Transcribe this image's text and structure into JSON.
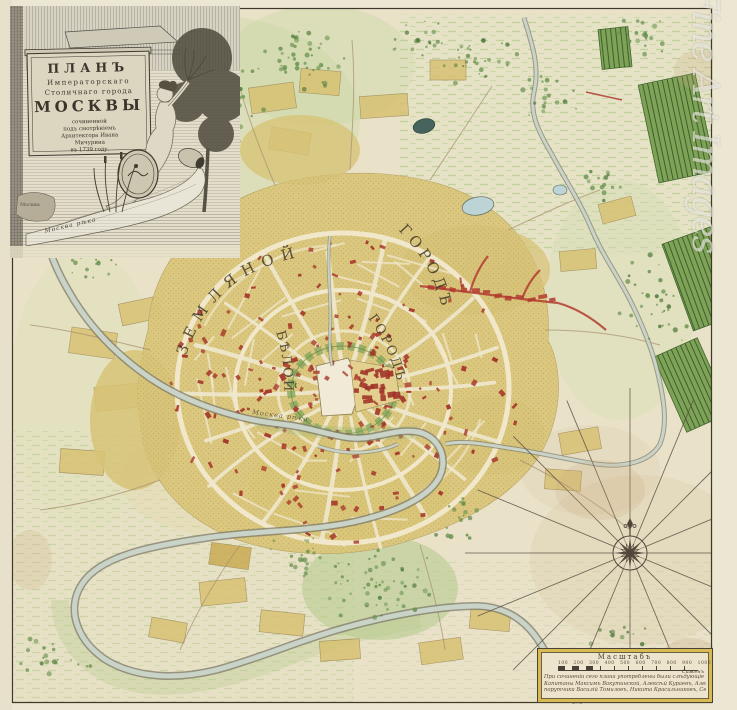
{
  "title_cartouche": {
    "l1": "ПЛАНЪ",
    "l2": "Императорскаго",
    "l3": "Столичнаго города",
    "l4": "МОСКВЫ",
    "l5": "сочиненной",
    "l6": "подъ смотрѣніемъ",
    "l7": "Архитектора Ивана",
    "l8": "Мичурина",
    "l9": "въ 1739 году.",
    "caption": "Москва",
    "stream_label": "Москва рѣка"
  },
  "map_labels": {
    "outer_ring_1": "ЗЕМЛЯНОЙ",
    "outer_ring_2": "ГОРОДЪ",
    "inner_ring_1": "БѢЛОЙ",
    "inner_ring_2": "ГОРОДЪ",
    "river": "Москва рѣка"
  },
  "legend": {
    "title": "Масштабъ",
    "ticks": "100 200 300 400 500 600 700 800 900 1000",
    "unit": "Саженъ",
    "note1": "При сочиненіи сего плана употреблены были слѣдующіе Геодезисты:",
    "note2": "Капитаны Максимъ Вакутинской, Алексѣй Кураевъ, Александръ Красовской,",
    "note3": "порутчики Василій Томиловъ, Никита Красильниковъ, Сергѣй Толмачевъ."
  },
  "watermark": "Fine Art Images",
  "colors": {
    "paper": "#e9e2c9",
    "city_block": "#dbc77b",
    "building_red": "#a83a2c",
    "river": "#c9d3c8",
    "meadow_green": "#cfddb0",
    "garden_green": "#7fa356",
    "legend_gold": "#d9b952",
    "ink": "#4a4236"
  }
}
